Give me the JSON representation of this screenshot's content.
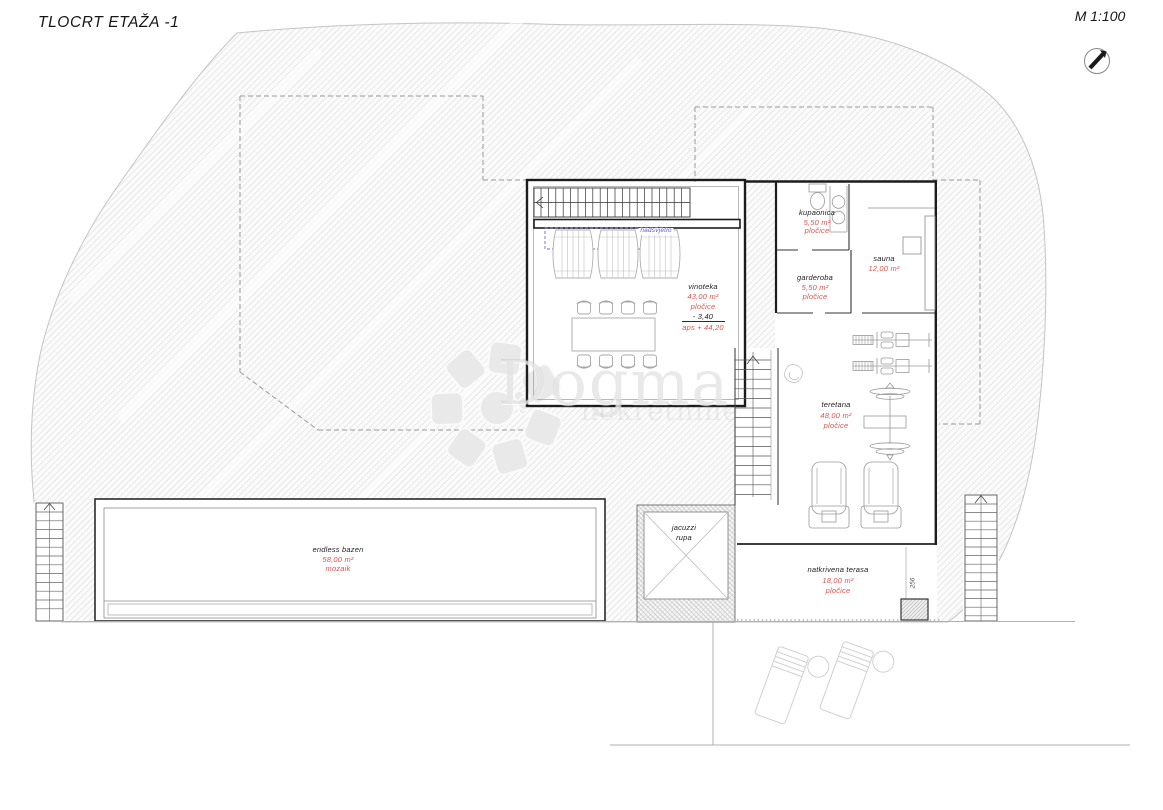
{
  "header": {
    "title": "TLOCRT ETAŽA -1",
    "scale": "M 1:100"
  },
  "watermark": {
    "brand": "Dogma",
    "subtitle": "nekretnine"
  },
  "annotations": {
    "skylight": "nadsvjetlo",
    "dim_terrace": "256"
  },
  "rooms": {
    "vinoteka": {
      "name": "vinoteka",
      "area": "43,00 m²",
      "finish": "pločice",
      "level": "- 3,40",
      "level_abs": "aps + 44,20"
    },
    "kupaonica": {
      "name": "kupaonica",
      "area": "5,50 m²",
      "finish": "pločice"
    },
    "sauna": {
      "name": "sauna",
      "area": "12,00 m²"
    },
    "garderoba": {
      "name": "garderoba",
      "area": "5,50 m²",
      "finish": "pločice"
    },
    "teretana": {
      "name": "teretana",
      "area": "48,00 m²",
      "finish": "pločice"
    },
    "jacuzzi": {
      "name": "jacuzzi",
      "name2": "rupa"
    },
    "bazen": {
      "name": "endless bazen",
      "area": "58,00 m²",
      "finish": "mozaik"
    },
    "terasa": {
      "name": "natkrivena terasa",
      "area": "18,00 m²",
      "finish": "pločice"
    }
  },
  "colors": {
    "area_red": "#d95550",
    "annotation_blue": "#5a5ace",
    "ink": "#1e1e1e"
  }
}
